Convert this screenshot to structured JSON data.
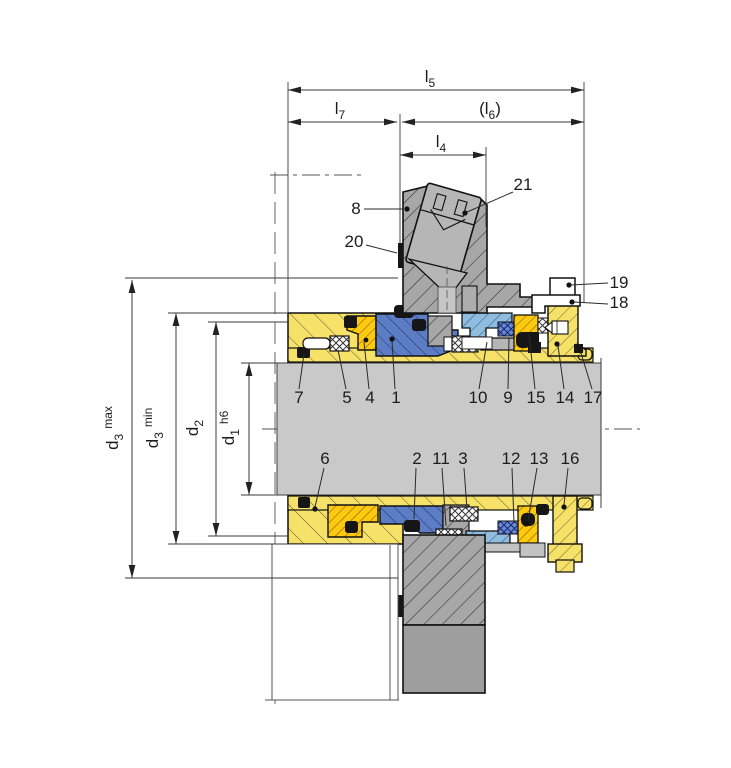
{
  "drawing": {
    "type": "mechanical-seal-cross-section",
    "description": "Dimensional cross-section drawing of a cartridge mechanical seal on a shaft with gland housing, flush port plug and numbered components"
  },
  "dims": {
    "l5sym": "l",
    "l5sub": "5",
    "l7sym": "l",
    "l7sub": "7",
    "l6pre": "(l",
    "l6sub": "6",
    "l6post": ")",
    "l4sym": "l",
    "l4sub": "4",
    "d3sym": "d",
    "d3sub": "3",
    "d3max_qual": "max",
    "d3min_qual": "min",
    "d2sym": "d",
    "d2sub": "2",
    "d1sym": "d",
    "d1sub": "1",
    "d1qual": "h6"
  },
  "parts": {
    "p1": "1",
    "p2": "2",
    "p3": "3",
    "p4": "4",
    "p5": "5",
    "p6": "6",
    "p7": "7",
    "p8": "8",
    "p9": "9",
    "p10": "10",
    "p11": "11",
    "p12": "12",
    "p13": "13",
    "p14": "14",
    "p15": "15",
    "p16": "16",
    "p17": "17",
    "p18": "18",
    "p19": "19",
    "p20": "20",
    "p21": "21"
  },
  "colors": {
    "pale_yellow": "#f6e269",
    "gold": "#ffc90e",
    "blue": "#5c7dc4",
    "light_blue": "#8fbcdf",
    "cross_blue": "#6b86d4",
    "housing_gray": "#a7a7a7",
    "shaft_gray": "#c9c9c9",
    "solid_gray": "#9e9e9e",
    "plug_gray": "#b6b6b6",
    "oring_black": "#161616",
    "white_part": "#ffffff"
  }
}
